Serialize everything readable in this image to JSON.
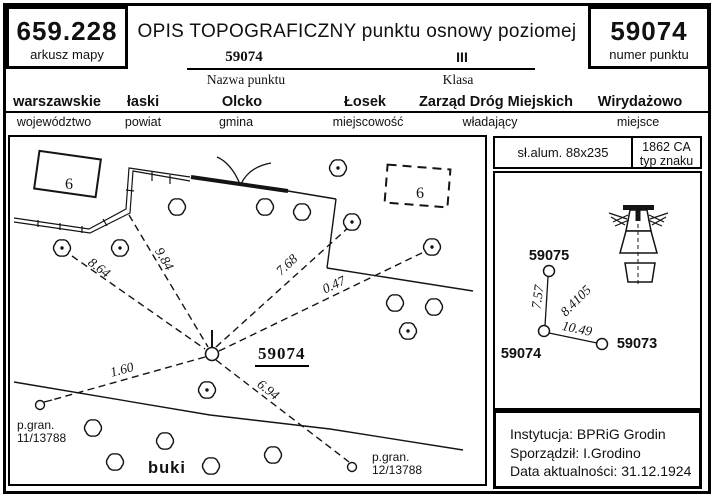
{
  "header": {
    "map_sheet_value": "659.228",
    "map_sheet_label": "arkusz mapy",
    "title": "OPIS TOPOGRAFICZNY punktu osnowy poziomej",
    "point_number_value": "59074",
    "point_number_label": "numer punktu",
    "point_name_value": "59074",
    "point_name_label": "Nazwa punktu",
    "class_value": "III",
    "class_label": "Klasa",
    "admin": [
      {
        "value": "warszawskie",
        "label": "województwo"
      },
      {
        "value": "łaski",
        "label": "powiat"
      },
      {
        "value": "Olcko",
        "label": "gmina"
      },
      {
        "value": "Łosek",
        "label": "miejscowość"
      },
      {
        "value": "Zarząd Dróg Miejskich",
        "label": "władający"
      },
      {
        "value": "Wirydażowo",
        "label": "miejsce"
      }
    ]
  },
  "marker_info": {
    "material": "sł.alum. 88x235",
    "type_value": "1862 CA",
    "type_label": "typ znaku"
  },
  "footer": {
    "lines": [
      "Instytucja: BPRiG Grodin",
      "Sporządził: I.Grodino",
      "Data aktualności: 31.12.1924"
    ]
  },
  "sketch": {
    "station": {
      "x": 212,
      "y": 354,
      "r": 6.5,
      "tick": [
        212,
        330,
        212,
        347
      ],
      "label": "59074",
      "label_x": 255,
      "label_y": 344
    },
    "vegetation": {
      "label": "buki",
      "x": 148,
      "y": 459
    },
    "fence": {
      "a": [
        [
          14,
          218
        ],
        [
          89,
          229
        ],
        [
          126,
          209
        ],
        [
          129,
          168
        ],
        [
          190,
          177
        ]
      ],
      "b": [
        [
          14,
          222
        ],
        [
          90,
          233
        ],
        [
          130,
          213
        ],
        [
          133,
          171
        ],
        [
          190,
          181
        ]
      ],
      "ticks": [
        [
          38,
          220,
          38,
          227
        ],
        [
          60,
          223,
          60,
          230
        ],
        [
          82,
          226,
          82,
          233
        ],
        [
          103,
          219,
          107,
          226
        ],
        [
          126,
          190,
          134,
          191
        ],
        [
          152,
          172,
          152,
          181
        ],
        [
          170,
          175,
          170,
          184
        ]
      ]
    },
    "walls": [
      [
        [
          191,
          177
        ],
        [
          288,
          191
        ]
      ]
    ],
    "lines": [
      [
        [
          288,
          191
        ],
        [
          336,
          199
        ]
      ],
      [
        [
          336,
          199
        ],
        [
          327,
          268
        ]
      ],
      [
        [
          327,
          268
        ],
        [
          473,
          291
        ]
      ],
      [
        [
          14,
          382
        ],
        [
          210,
          415
        ],
        [
          330,
          429
        ],
        [
          463,
          450
        ]
      ]
    ],
    "tuft": [
      "M240,184Q231,163 217,157",
      "M241,184Q249,167 271,163"
    ],
    "buildings": [
      {
        "cx": 67.5,
        "cy": 174,
        "w": 62,
        "h": 38,
        "rot": 8,
        "dashed": false,
        "label": "6",
        "label_x": 69,
        "label_y": 189
      },
      {
        "cx": 417.5,
        "cy": 186,
        "w": 63,
        "h": 38,
        "rot": 4.5,
        "dashed": true,
        "label": "6",
        "label_x": 420,
        "label_y": 198
      }
    ],
    "trees": [
      [
        177,
        207,
        0
      ],
      [
        265,
        207,
        0
      ],
      [
        302,
        212,
        0
      ],
      [
        352,
        222,
        1
      ],
      [
        395,
        303,
        0
      ],
      [
        434,
        307,
        0
      ],
      [
        93,
        428,
        0
      ],
      [
        115,
        462,
        0
      ],
      [
        165,
        441,
        0
      ],
      [
        211,
        466,
        0
      ],
      [
        273,
        455,
        0
      ],
      [
        62,
        248,
        1
      ],
      [
        120,
        248,
        1
      ],
      [
        338,
        168,
        1
      ],
      [
        432,
        247,
        1
      ],
      [
        408,
        331,
        1
      ],
      [
        207,
        390,
        1
      ]
    ],
    "measurements": [
      {
        "label": "8.64",
        "x1": 72,
        "y1": 256,
        "x2": 205,
        "y2": 349,
        "lx": 99,
        "ly": 268,
        "rot": 37
      },
      {
        "label": "9.84",
        "x1": 129,
        "y1": 215,
        "x2": 208,
        "y2": 347,
        "lx": 164,
        "ly": 259,
        "rot": 60
      },
      {
        "label": "7.68",
        "x1": 216,
        "y1": 347,
        "x2": 349,
        "y2": 227,
        "lx": 287,
        "ly": 265,
        "rot": -43
      },
      {
        "label": "0.47",
        "x1": 219,
        "y1": 351,
        "x2": 428,
        "y2": 250,
        "lx": 334,
        "ly": 285,
        "rot": -25
      },
      {
        "label": "1.60",
        "x1": 205,
        "y1": 357,
        "x2": 52,
        "y2": 400,
        "lx": 122,
        "ly": 370,
        "rot": -15
      },
      {
        "label": "6.94",
        "x1": 216,
        "y1": 360,
        "x2": 349,
        "y2": 462,
        "lx": 268,
        "ly": 390,
        "rot": 38
      }
    ],
    "boundary_markers": [
      {
        "cx": 40,
        "cy": 405,
        "r": 4.5,
        "stem": [
          44,
          402,
          52,
          400
        ],
        "line1": "p.gran.",
        "line2": "11/13788",
        "tx": 17,
        "ty": 419
      },
      {
        "cx": 352,
        "cy": 467,
        "r": 4.5,
        "stem": null,
        "line1": "p.gran.",
        "line2": "12/13788",
        "tx": 372,
        "ty": 451
      }
    ]
  },
  "network": {
    "points": [
      {
        "name": "59075",
        "cx": 549,
        "cy": 271,
        "lx": 549,
        "ly": 256
      },
      {
        "name": "59074",
        "cx": 544,
        "cy": 331,
        "lx": 521,
        "ly": 354
      },
      {
        "name": "59073",
        "cx": 602,
        "cy": 344,
        "lx": 637,
        "ly": 344
      }
    ],
    "edges": [
      [
        548,
        277,
        545,
        326
      ],
      [
        549,
        333,
        597,
        343
      ]
    ],
    "distances": [
      {
        "label": "7.57",
        "x": 538,
        "y": 297,
        "rot": -82
      },
      {
        "label": "8.4105",
        "x": 576,
        "y": 301,
        "rot": -45
      },
      {
        "label": "10.49",
        "x": 577,
        "y": 329,
        "rot": 12
      }
    ]
  }
}
